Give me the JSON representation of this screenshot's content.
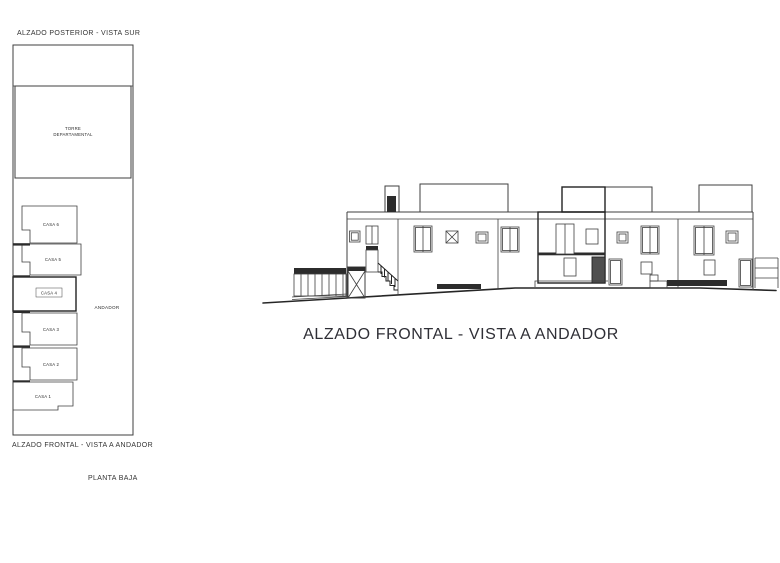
{
  "colors": {
    "paper": "#ffffff",
    "line": "#3f3f3f",
    "dark_fill": "#2c2c2c"
  },
  "site_plan": {
    "title": "ALZADO POSTERIOR - VISTA SUR",
    "tower_label_lines": [
      "TORRE",
      "DEPARTAMENTAL"
    ],
    "houses": [
      {
        "label": "CASA 6",
        "highlighted": false
      },
      {
        "label": "CASA 5",
        "highlighted": false
      },
      {
        "label": "CASA 4",
        "highlighted": true
      },
      {
        "label": "CASA 3",
        "highlighted": false
      },
      {
        "label": "CASA 2",
        "highlighted": false
      },
      {
        "label": "CASA 1",
        "highlighted": false
      }
    ],
    "walkway_label": "ANDADOR",
    "caption": "ALZADO FRONTAL - VISTA A ANDADOR",
    "floor_label": "PLANTA BAJA"
  },
  "elevation": {
    "title": "ALZADO FRONTAL - VISTA A ANDADOR"
  }
}
